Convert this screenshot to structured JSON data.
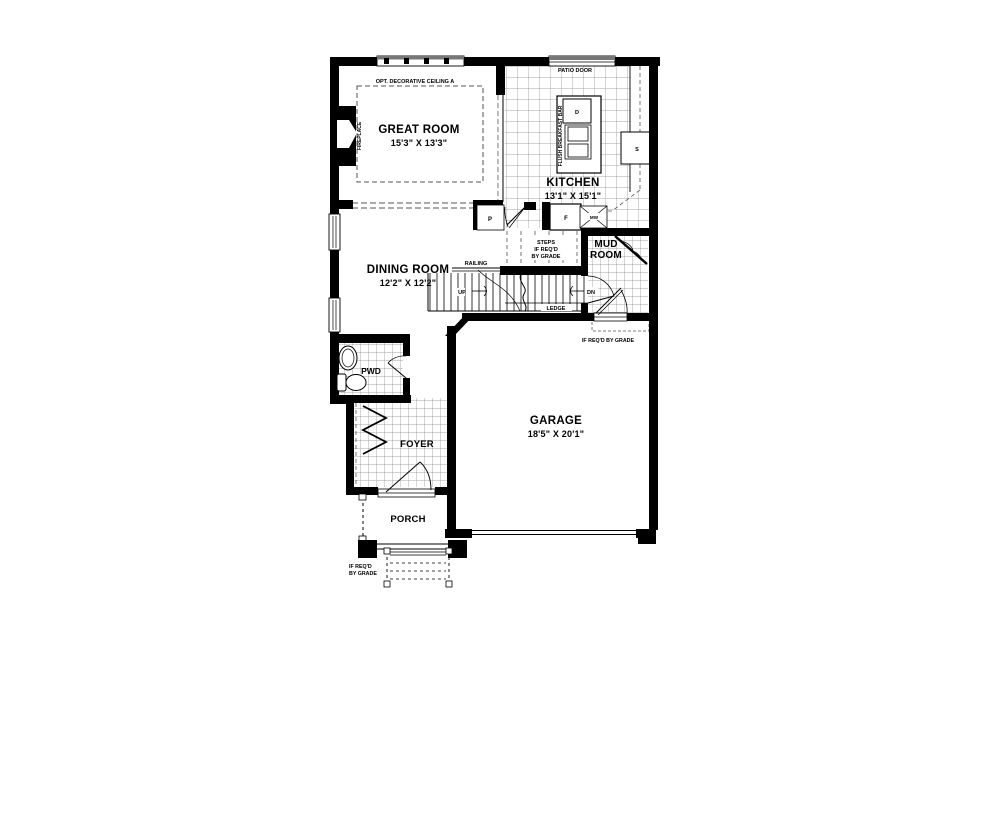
{
  "plan": {
    "rooms": {
      "great_room": {
        "name": "GREAT ROOM",
        "dims": "15'3\" X 13'3\""
      },
      "kitchen": {
        "name": "KITCHEN",
        "dims": "13'1\" X 15'1\""
      },
      "dining_room": {
        "name": "DINING ROOM",
        "dims": "12'2\" X 12'2\""
      },
      "garage": {
        "name": "GARAGE",
        "dims": "18'5\" X 20'1\""
      },
      "mud_room": {
        "line1": "MUD",
        "line2": "ROOM"
      },
      "foyer": "FOYER",
      "porch": "PORCH",
      "pwd": "PWD"
    },
    "labels": {
      "opt_ceiling": "OPT. DECORATIVE CEILING A",
      "patio_door": "PATIO DOOR",
      "flush_breakfast_bar": "FLUSH BREAKFAST BAR",
      "fireplace": "FIREPLACE",
      "railing": "RAILING",
      "up": "UP",
      "dn": "DN",
      "ledge": "LEDGE",
      "steps": {
        "line1": "STEPS",
        "line2": "IF REQ'D",
        "line3": "BY GRADE"
      },
      "grade_note_garage": "IF REQ'D BY GRADE",
      "grade_note_porch": {
        "line1": "IF REQ'D",
        "line2": "BY GRADE"
      }
    },
    "appliances": {
      "dishwasher": "D",
      "sink": "S",
      "pantry": "P",
      "fridge": "F",
      "microwave": "MW"
    },
    "colors": {
      "wall": "#000000",
      "tile_grid": "#8a8a8a",
      "dashed": "#555555",
      "background": "#ffffff"
    }
  }
}
